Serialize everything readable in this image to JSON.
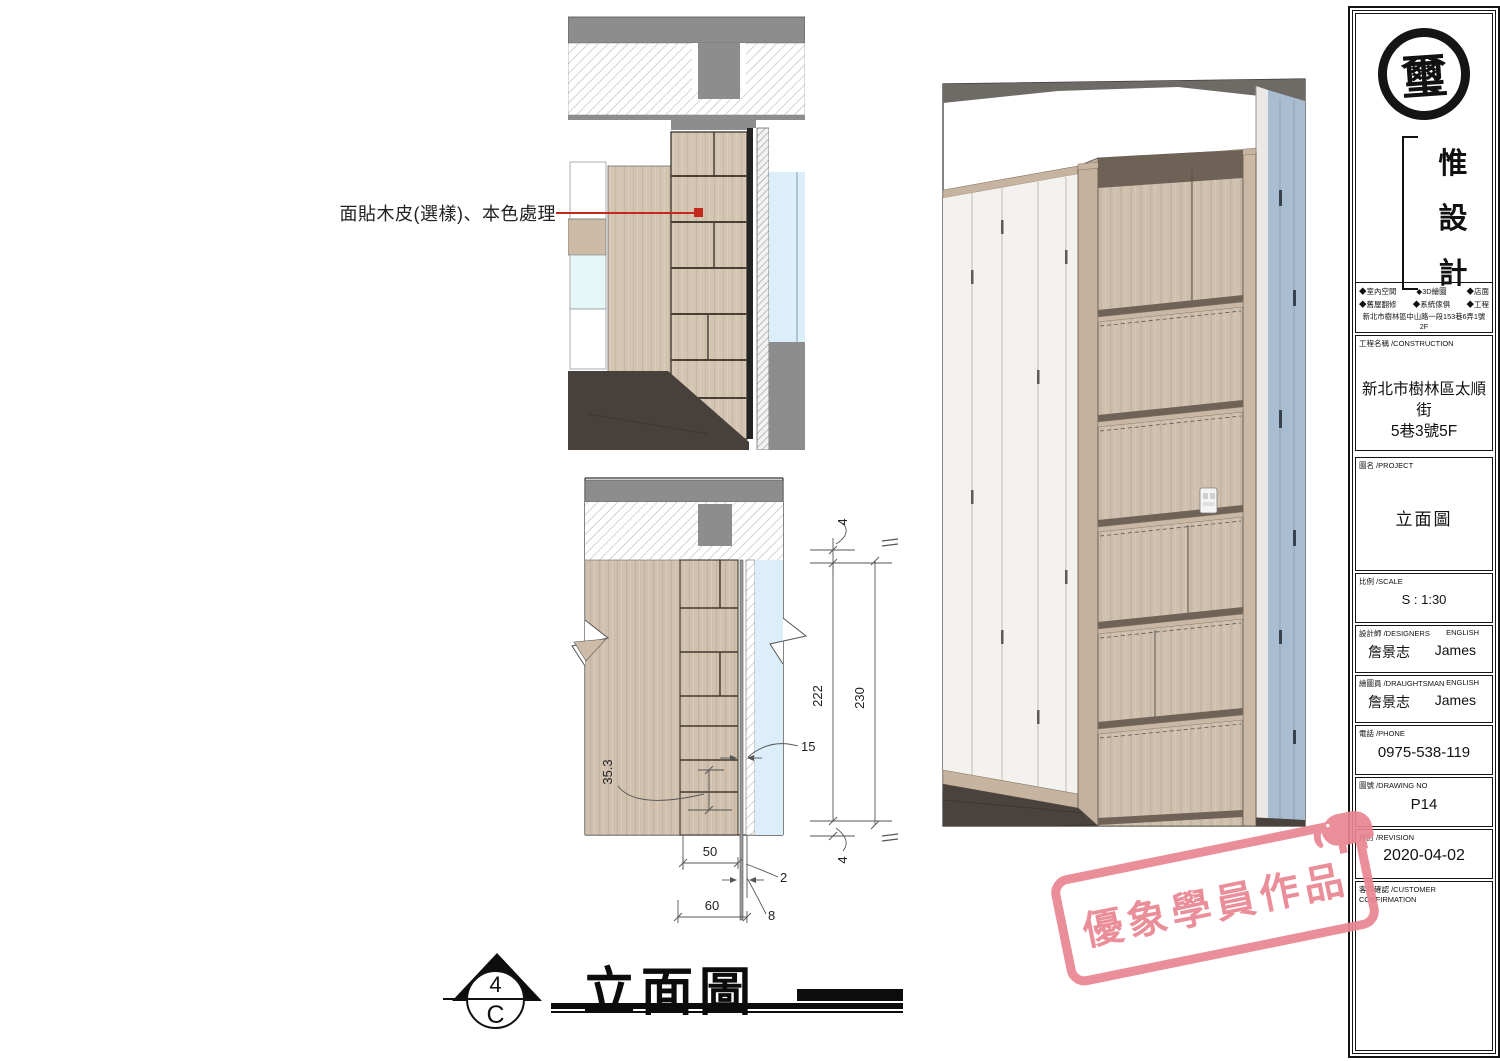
{
  "annotation": {
    "text": "面貼木皮(選樣)、本色處理",
    "leader_color": "#c22a1d"
  },
  "drawing_title": {
    "marker_number": "4",
    "marker_letter": "C",
    "title": "立面圖"
  },
  "detail_dimensions": {
    "top_gap": "4",
    "inner_height": "222",
    "overall_height": "230",
    "recess": "15",
    "angle_width": "35.3",
    "inner_depth": "50",
    "reveal": "2",
    "overall_depth": "60",
    "edge_offset": "8",
    "bottom_gap": "4"
  },
  "title_block": {
    "seal_character": "璽",
    "brand_characters": [
      "惟",
      "設",
      "計"
    ],
    "service_bullet": "◆",
    "services": [
      "室內空間",
      "3D繪圖",
      "店面",
      "舊屋翻修",
      "系統傢俱",
      "工程"
    ],
    "address": "新北市樹林區中山路一段153巷6弄1號2F",
    "fields": [
      {
        "label": "工程名稱 /CONSTRUCTION",
        "value_line1": "新北市樹林區太順街",
        "value_line2": "5巷3號5F"
      },
      {
        "label": "圖名 /PROJECT",
        "value": "立面圖"
      },
      {
        "label": "比例 /SCALE",
        "value": "S : 1:30"
      },
      {
        "label": "設計師 /DESIGNERS",
        "label_en": "ENGLISH",
        "value": "詹景志",
        "value_en": "James"
      },
      {
        "label": "繪圖員 /DRAUGHTSMAN",
        "label_en": "ENGLISH",
        "value": "詹景志",
        "value_en": "James"
      },
      {
        "label": "電話 /PHONE",
        "value": "0975-538-119"
      },
      {
        "label": "圖號 /DRAWING NO",
        "value": "P14"
      },
      {
        "label": "修訂 /REVISION",
        "value": "2020-04-02"
      },
      {
        "label": "客戶確認 /CUSTOMER CONFIRMATION",
        "value": ""
      }
    ]
  },
  "watermark": {
    "text": "優象學員作品",
    "color": "#e98591"
  },
  "colors": {
    "wood": "#d4c5b3",
    "slab_gray": "#8d8d8d",
    "glass_blue": "#ddeefb",
    "wall_blue": "#a9bdd0",
    "floor_dark": "#4a423c",
    "accent_red": "#c22a1d"
  }
}
